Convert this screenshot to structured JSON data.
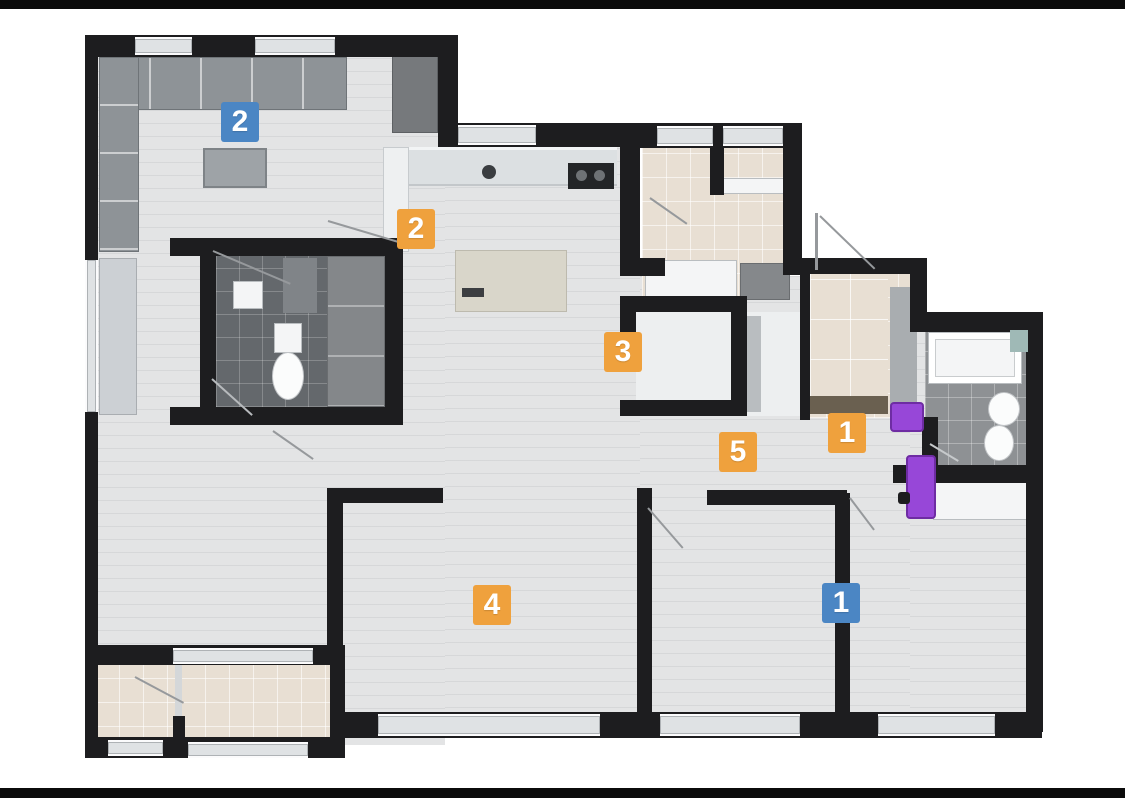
{
  "document": {
    "type": "apartment-floor-plan",
    "background": "#ffffff"
  },
  "palette": {
    "letterbox": "#0b0b0b",
    "wall": "#1d1d1f",
    "wood_floor": "#e3e4e5",
    "tile_beige": "#e8dfd3",
    "tile_dark": "#64686c",
    "tile_gray": "#8e9194",
    "accent_orange": "#efa13d",
    "accent_blue": "#4b86c4",
    "accent_purple": "#9747d8"
  },
  "badges": [
    {
      "room": "living-room",
      "value": "2",
      "style": "blue"
    },
    {
      "room": "kitchen",
      "value": "2",
      "style": "orange"
    },
    {
      "room": "storage-room",
      "value": "3",
      "style": "orange"
    },
    {
      "room": "entry-hall",
      "value": "1",
      "style": "orange"
    },
    {
      "room": "corridor",
      "value": "5",
      "style": "orange"
    },
    {
      "room": "main-room",
      "value": "4",
      "style": "orange"
    },
    {
      "room": "bedroom",
      "value": "1",
      "style": "blue"
    }
  ],
  "fixtures": {
    "highlight_color_note": "purple highlighted fixtures near right bathroom door"
  }
}
